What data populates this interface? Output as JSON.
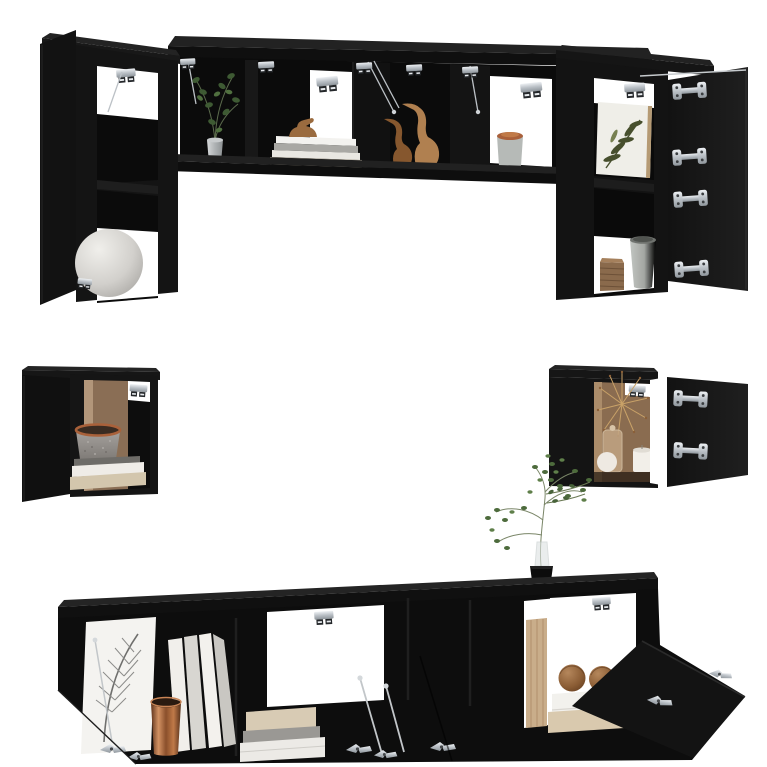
{
  "scene": {
    "type": "product-photo",
    "description": "8-piece black wall-mounted TV cabinet set with open flip doors, styled with decor items, on a plain white studio background",
    "background_color": "#ffffff",
    "furniture_color": "#121212",
    "hardware_color": "#c9cdd1"
  },
  "palette": {
    "black": "#121212",
    "interior_shadow": "#0b0b0b",
    "silver": "#c9cdd1",
    "white": "#ffffff",
    "interior_brown": "#8a6c50",
    "copper": "#b06a3f",
    "wood": "#a97a4a",
    "green": "#4d6b3c",
    "beige": "#d4c9b6",
    "gray": "#9a9894"
  },
  "pieces": [
    {
      "id": "wall-cabinet-top-long",
      "name": "Top hanging cabinet row with lifted flip doors",
      "contents": [
        "potted green plant in silver pot",
        "stack of books with small wooden duck on top",
        "two wooden duck figurines",
        "grey canister with copper lid"
      ],
      "hardware": [
        "soft-close hinges",
        "gas lift arms"
      ],
      "state": "doors open"
    },
    {
      "id": "wall-cabinet-upper-left",
      "name": "Upper left two-compartment hanging cabinet",
      "contents": [
        "large light-grey decorative sphere"
      ],
      "state": "door open"
    },
    {
      "id": "wall-cabinet-upper-right",
      "name": "Upper right two-compartment hanging cabinet",
      "contents": [
        "leaf artwork canvas",
        "grey cup",
        "ribbed brown box"
      ],
      "state": "door open"
    },
    {
      "id": "wall-cabinet-mid-left",
      "name": "Middle left wall cube cabinet",
      "contents": [
        "speckled stone pot with copper rim",
        "stack of books"
      ],
      "state": "door open"
    },
    {
      "id": "wall-cabinet-mid-right",
      "name": "Middle right wall cube cabinet",
      "contents": [
        "dried flower starburst",
        "glass jar",
        "white candle",
        "white ball",
        "green sprigs"
      ],
      "state": "door open"
    },
    {
      "id": "tv-stand-bottom",
      "name": "Low wall-mounted TV stand with drop-down doors",
      "contents": [
        "feather artwork canvas",
        "standing white books",
        "copper vase",
        "stack of books",
        "two wooden spheres on white book and board",
        "delicate green plant in glass vase with black pot"
      ],
      "state": "doors open"
    }
  ]
}
